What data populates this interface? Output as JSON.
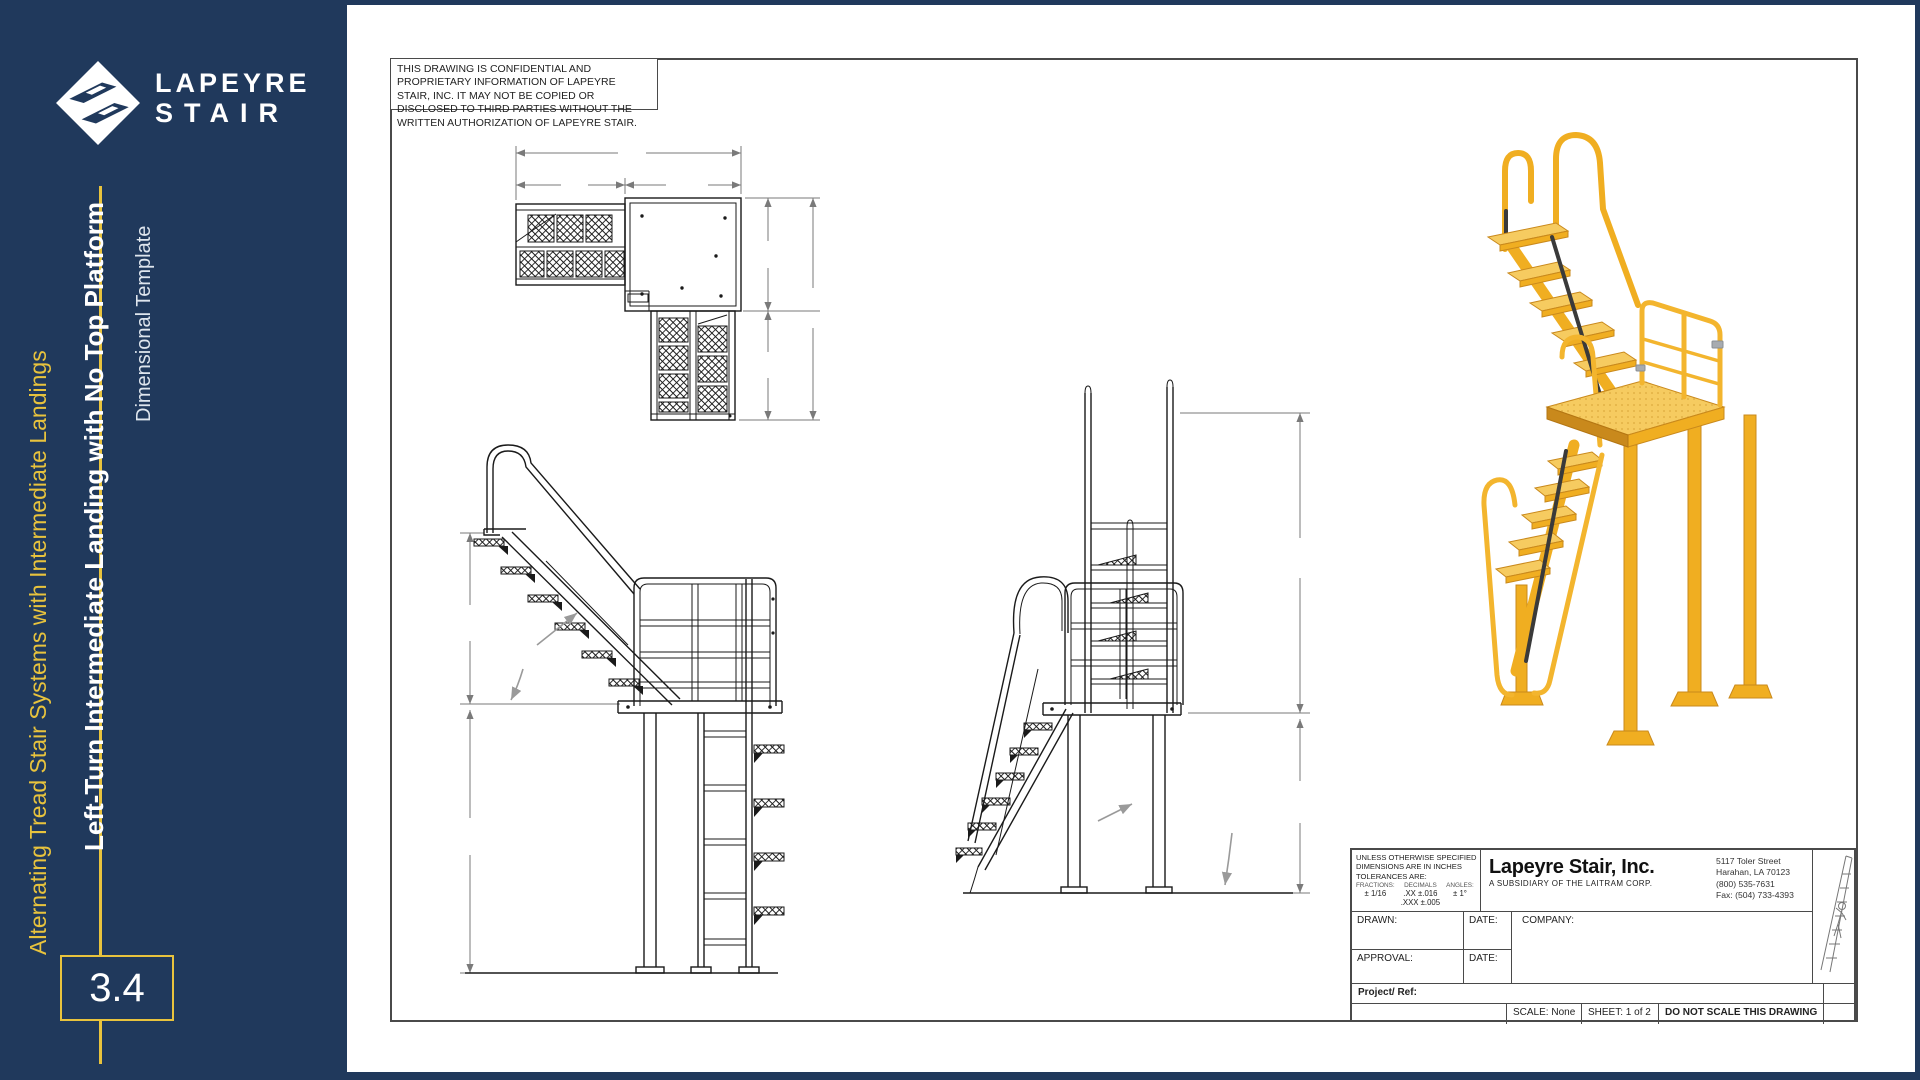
{
  "colors": {
    "navy": "#20395C",
    "gold": "#E8C33D",
    "paper": "#FFFFFF",
    "drawing_line": "#1A1A1A",
    "dimension_line": "#7A7A7A",
    "render_yellow": "#F0AE21",
    "render_yellow_light": "#F6CB60",
    "render_yellow_dark": "#C9891C"
  },
  "sidebar": {
    "logo": {
      "line1": "LAPEYRE",
      "line2": "STAIR"
    },
    "series_title": "Alternating Tread Stair Systems with Intermediate Landings",
    "page_title": "Left-Turn Intermediate Landing with No Top Platform",
    "subtitle": "Dimensional Template",
    "page_number": "3.4"
  },
  "drawing": {
    "confidentiality_note": "THIS DRAWING IS CONFIDENTIAL AND PROPRIETARY INFORMATION OF LAPEYRE STAIR, INC. IT MAY NOT BE COPIED OR DISCLOSED TO THIRD PARTIES WITHOUT THE WRITTEN AUTHORIZATION OF LAPEYRE STAIR."
  },
  "title_block": {
    "tolerances": {
      "header_line1": "UNLESS OTHERWISE SPECIFIED",
      "header_line2": "DIMENSIONS ARE IN INCHES",
      "header_line3": "TOLERANCES ARE:",
      "fractions_label": "FRACTIONS:",
      "fractions_value": "± 1/16",
      "decimals_label": "DECIMALS",
      "decimals_value_xx": ".XX ±.016",
      "decimals_value_xxx": ".XXX ±.005",
      "angles_label": "ANGLES:",
      "angles_value": "± 1°"
    },
    "company_name": "Lapeyre Stair, Inc.",
    "company_subtitle": "A SUBSIDIARY OF THE LAITRAM CORP.",
    "address_lines": [
      "5117 Toler Street",
      "Harahan, LA 70123",
      "(800) 535-7631",
      "Fax: (504) 733-4393"
    ],
    "fields": {
      "drawn_label": "DRAWN:",
      "date_label_1": "DATE:",
      "company_label": "COMPANY:",
      "approval_label": "APPROVAL:",
      "date_label_2": "DATE:",
      "project_ref_label": "Project/ Ref:"
    },
    "scale_label": "SCALE: None",
    "sheet_label": "SHEET: 1 of 2",
    "warning": "DO NOT SCALE THIS DRAWING"
  }
}
